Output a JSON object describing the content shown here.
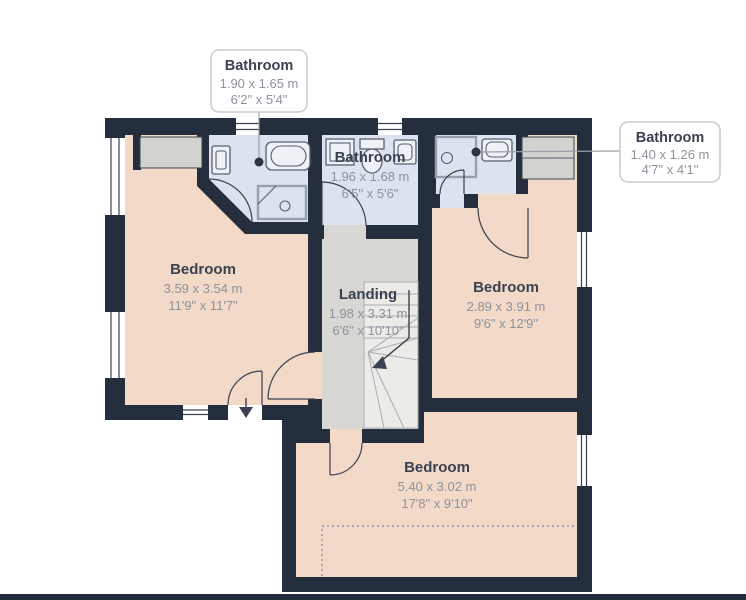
{
  "plan": {
    "type": "floorplan",
    "floor_hint": "first floor with three bedrooms, three bathrooms, landing and stairs"
  },
  "colors": {
    "wall": "#242e3d",
    "bedroom_floor": "#f3d9c7",
    "bathroom_floor": "#dde3ee",
    "landing_floor": "#d8d7d4",
    "stairs_floor": "#ecebe8",
    "furniture": "#d2d2cf",
    "label_title": "#3a4150",
    "label_dims": "#8d929b",
    "callout_border": "#c7cad0",
    "bottom_bar": "#252c3a"
  },
  "callouts": [
    {
      "name": "bathroom-top",
      "title": "Bathroom",
      "metric": "1.90 x 1.65 m",
      "imperial": "6'2\" x 5'4\""
    },
    {
      "name": "bathroom-right",
      "title": "Bathroom",
      "metric": "1.40 x 1.26 m",
      "imperial": "4'7\" x 4'1\""
    }
  ],
  "rooms": [
    {
      "name": "bathroom-middle",
      "title": "Bathroom",
      "metric": "1.96 x 1.68 m",
      "imperial": "6'5\" x 5'6\""
    },
    {
      "name": "bedroom-left",
      "title": "Bedroom",
      "metric": "3.59 x 3.54 m",
      "imperial": "11'9\" x 11'7\""
    },
    {
      "name": "landing",
      "title": "Landing",
      "metric": "1.98 x 3.31 m",
      "imperial": "6'6\" x 10'10\""
    },
    {
      "name": "bedroom-right",
      "title": "Bedroom",
      "metric": "2.89 x 3.91 m",
      "imperial": "9'6\" x 12'9\""
    },
    {
      "name": "bedroom-bottom",
      "title": "Bedroom",
      "metric": "5.40 x 3.02 m",
      "imperial": "17'8\" x 9'10\""
    }
  ]
}
